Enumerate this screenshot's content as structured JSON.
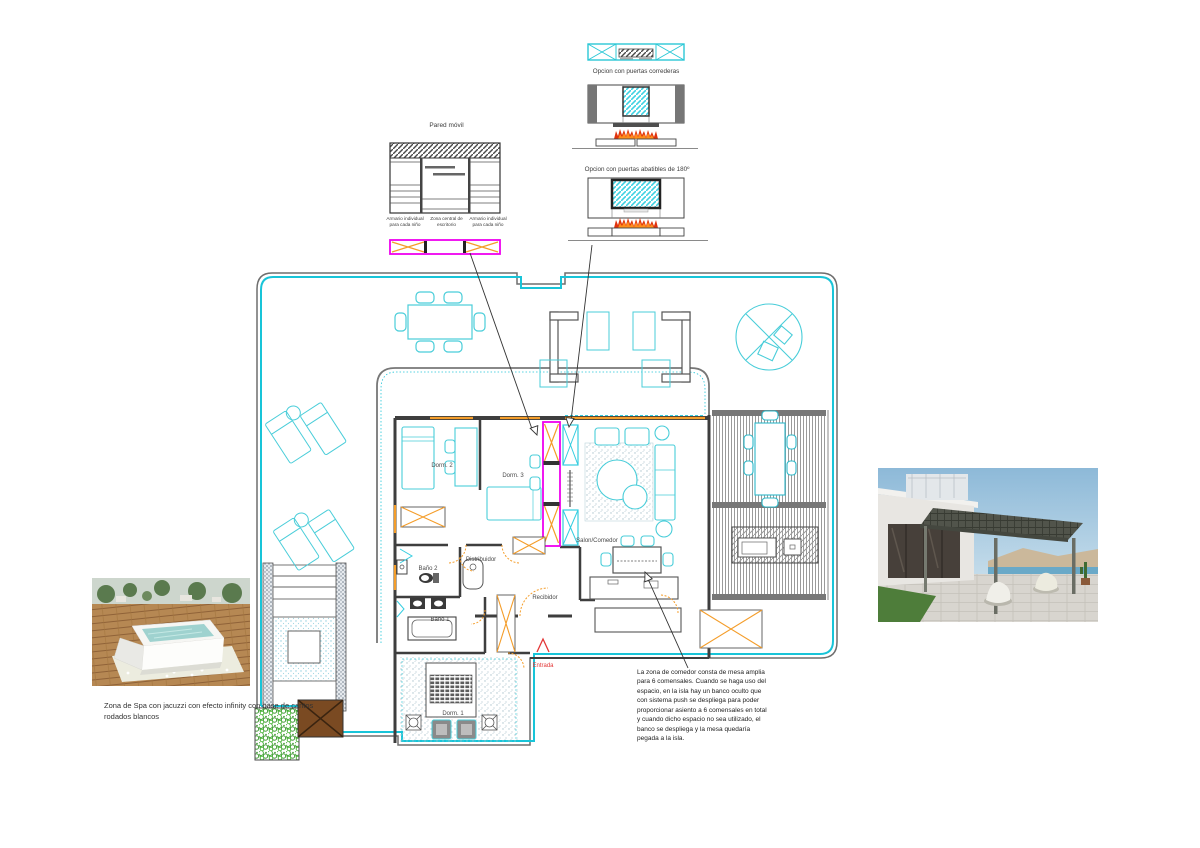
{
  "pared_movil": {
    "title": "Pared móvil",
    "captions": [
      "Armario individual para cada niño",
      "Zona central de escritorio",
      "Armario individual para cada niño"
    ]
  },
  "fireplace": {
    "option_sliding": "Opcion con puertas correderas",
    "option_folding": "Opcion con puertas abatibles de 180º"
  },
  "plan": {
    "rooms": {
      "dorm2": "Dorm. 2",
      "dorm3": "Dorm. 3",
      "distribuidor": "Distribuidor",
      "bano2": "Baño 2",
      "bano1": "Baño 1",
      "recibidor": "Recibidor",
      "salon": "Salon/Comedor",
      "dorm1": "Dorm. 1",
      "entrada": "Entrada"
    },
    "colors": {
      "boundary_cyan": "#18c4d8",
      "furniture_cyan": "#49cdd9",
      "window_orange": "#f49d2a",
      "movable_wall_magenta": "#ee00ee",
      "entry_red": "#e33636",
      "vegetation_green": "#3aa52c",
      "wood_brown": "#7a4a22",
      "flame_red": "#e0330d",
      "flame_orange": "#ff8d1c"
    }
  },
  "spa": {
    "caption": "Zona de Spa con jacuzzi con efecto infinity con base de cantos rodados blancos"
  },
  "dining_note": "La zona de comedor consta de mesa amplia para 6 comensales. Cuando se haga uso del espacio, en la isla hay un banco oculto que con sistema push se despliega para poder proporcionar asiento a 6 comensales en total y cuando dicho espacio no sea utilizado, el banco se despliega y la mesa quedaría pegada a la isla."
}
